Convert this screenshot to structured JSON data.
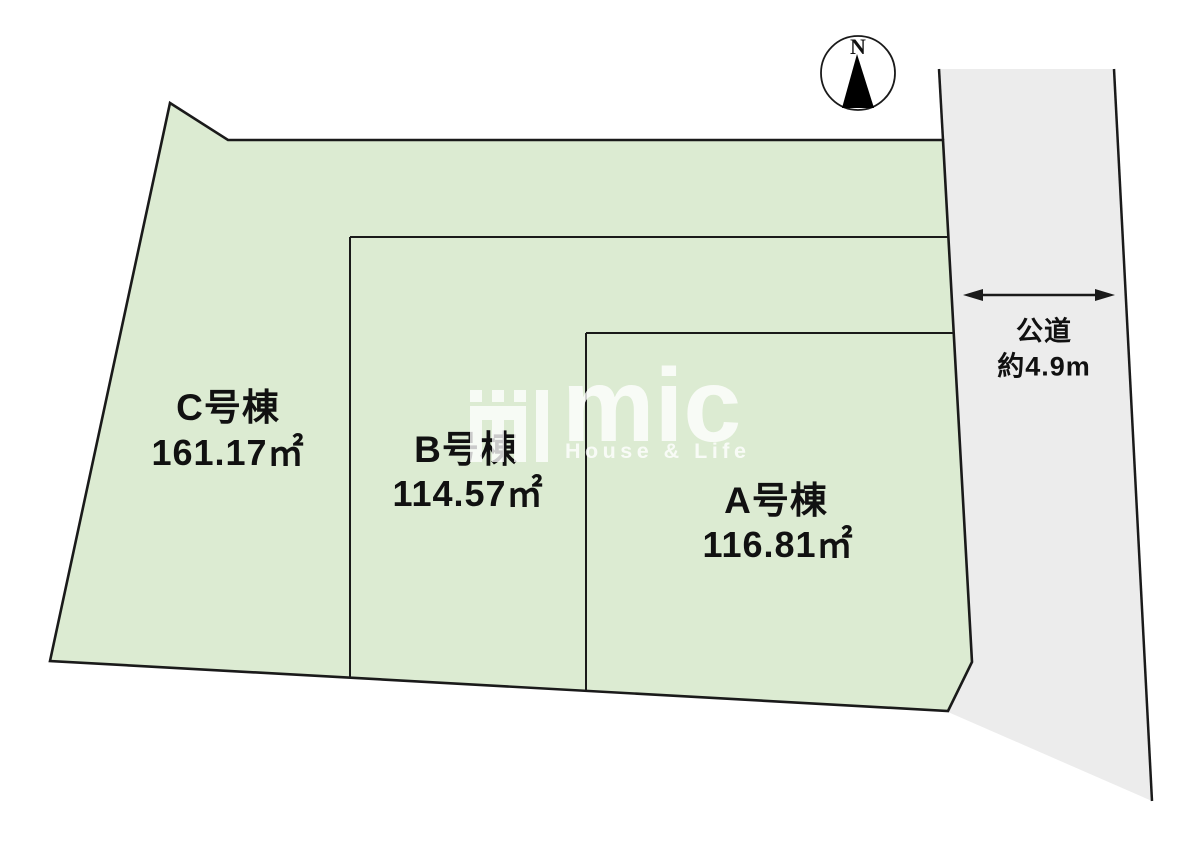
{
  "diagram_title": "分譲区画図",
  "lots": [
    {
      "id": "C",
      "label": "C号棟",
      "area": "161.17㎡"
    },
    {
      "id": "B",
      "label": "B号棟",
      "area": "114.57㎡"
    },
    {
      "id": "A",
      "label": "A号棟",
      "area": "116.81㎡"
    }
  ],
  "road": {
    "name": "公道",
    "width": "約4.9m"
  },
  "compass": {
    "north_label": "N"
  },
  "watermark": {
    "logo_text": "mic",
    "tagline": "House & Life"
  },
  "colors": {
    "lot_fill": "#dcebd2",
    "road_fill": "#ececec",
    "line": "#1a1a1a",
    "text": "#111111"
  }
}
